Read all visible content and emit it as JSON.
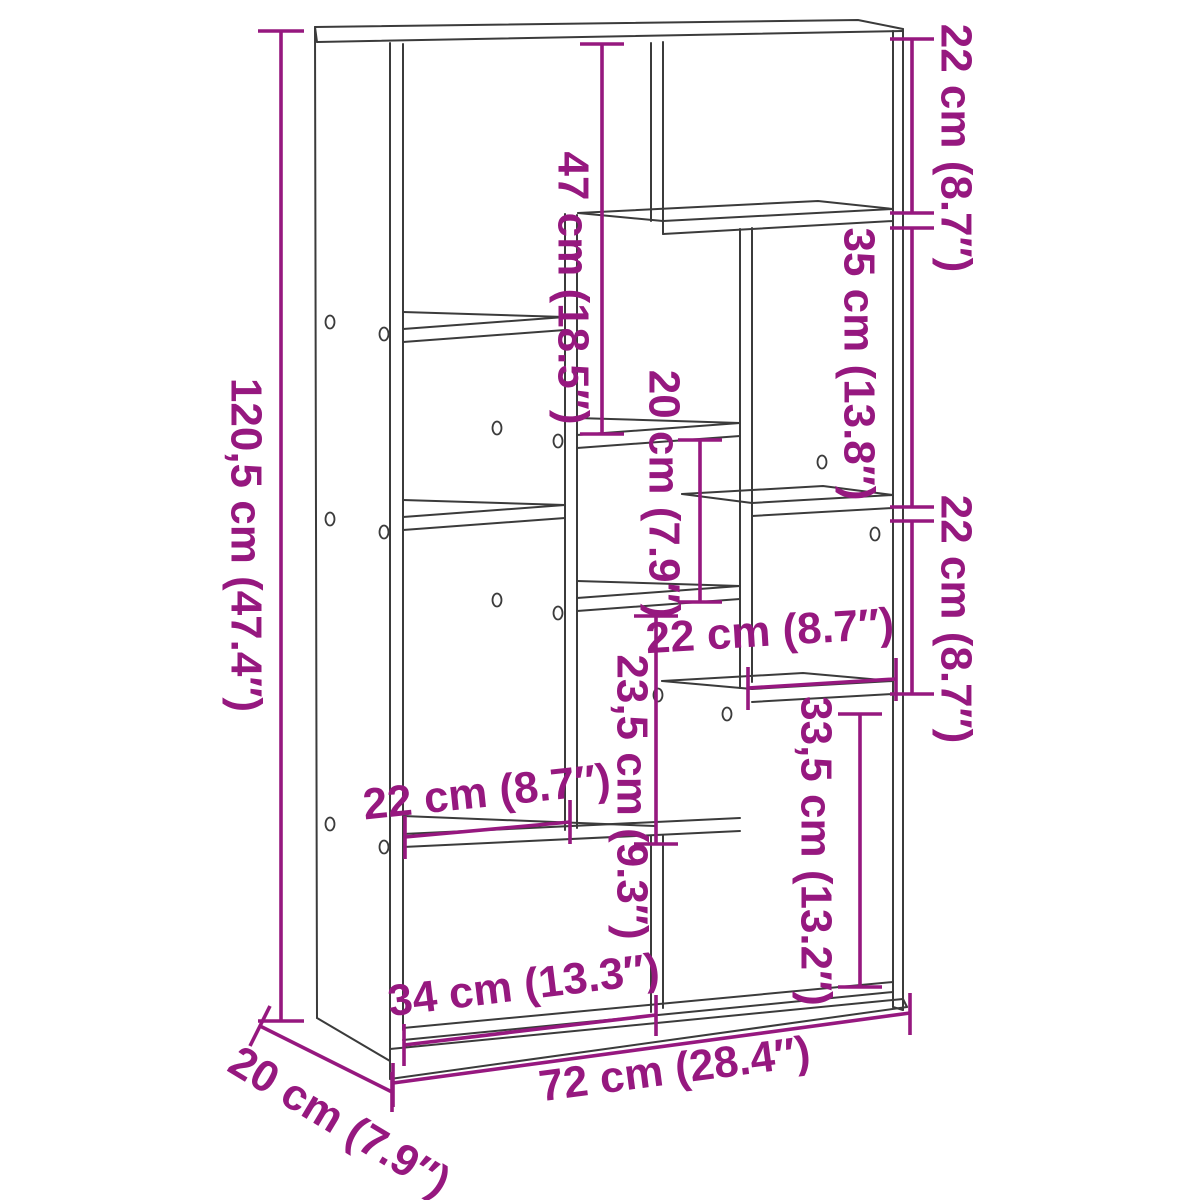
{
  "diagram": {
    "title": "bookcase-dimension-diagram",
    "colors": {
      "dimension": "#96187f",
      "outline": "#3b3b3b",
      "background": "#ffffff"
    },
    "labels": {
      "height": "120,5 cm (47.4″)",
      "depth": "20 cm (7.9″)",
      "width": "72 cm (28.4″)",
      "bottom_left_width": "34 cm (13.3″)",
      "top_middle_height": "47 cm (18.5″)",
      "top_right_height": "22 cm (8.7″)",
      "right_upper_height": "35 cm (13.8″)",
      "right_middle_height": "22 cm (8.7″)",
      "middle_cubby_height": "20 cm (7.9″)",
      "middle_width": "22 cm (8.7″)",
      "middle_lower_height": "23,5 cm (9.3″)",
      "bottom_right_height": "33,5 cm (13.2″)",
      "left_width": "22 cm (8.7″)"
    }
  }
}
